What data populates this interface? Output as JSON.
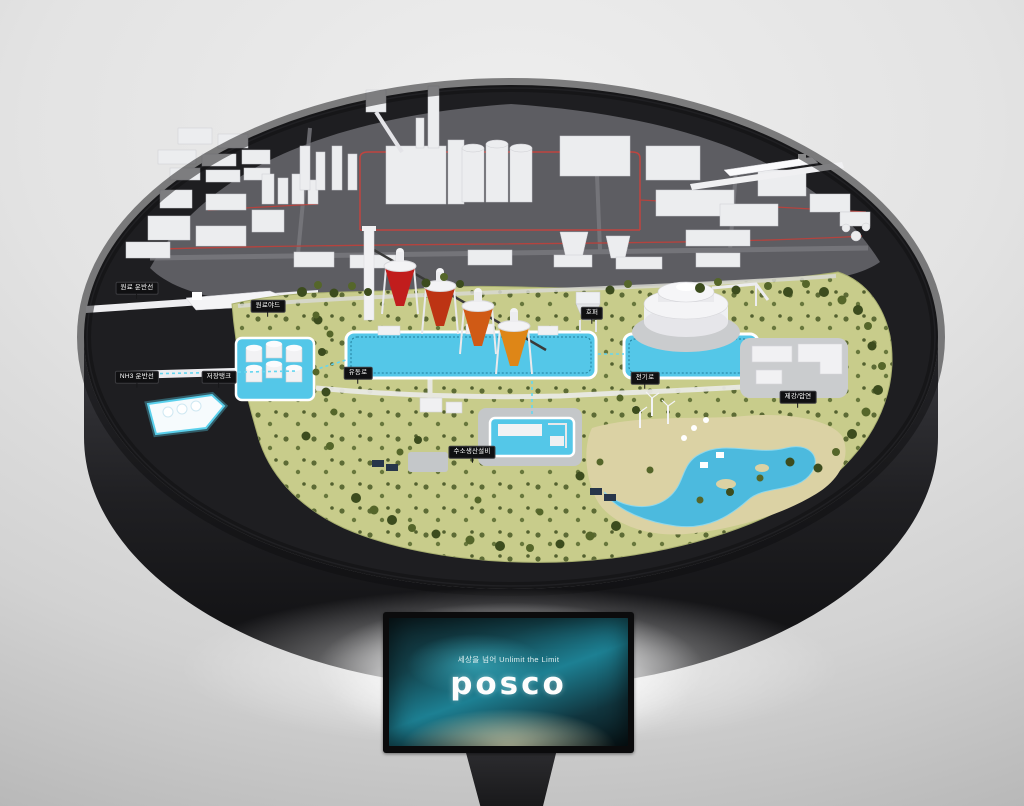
{
  "scene": {
    "labels": [
      {
        "text": "원료 운반선"
      },
      {
        "text": "NH3 운반선"
      },
      {
        "text": "저장탱크"
      },
      {
        "text": "원료야드"
      },
      {
        "text": "유동로"
      },
      {
        "text": "수소생산설비"
      },
      {
        "text": "호퍼"
      },
      {
        "text": "전기로"
      },
      {
        "text": "제강/압연"
      }
    ],
    "monitor": {
      "tagline": "세상을 넘어 Unlimit the Limit",
      "logo": "posco"
    },
    "colors": {
      "table_charcoal": "#1e1e21",
      "pipeline_red": "#b5433e",
      "water_cyan": "#54c7e8",
      "terrain_green": "#c8cc8b",
      "tree_green": "#44541f",
      "furnace_red": "#c11d1d",
      "furnace_orange": "#de8617",
      "screen_teal": "#1d8093"
    }
  }
}
